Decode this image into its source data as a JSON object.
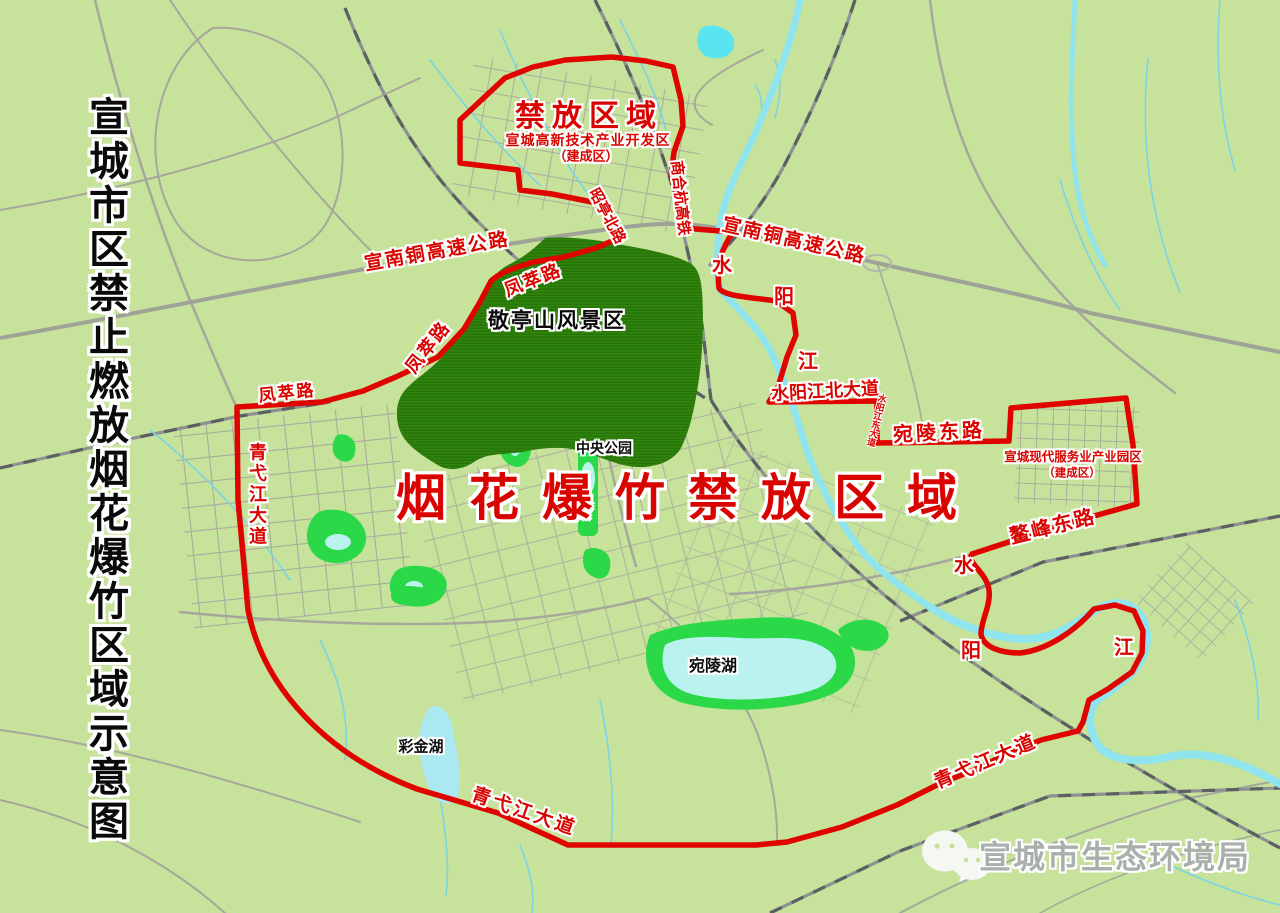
{
  "map_title": "宣城市区禁止燃放烟花爆竹区域示意图",
  "zones": {
    "north": {
      "title": "禁放区域",
      "subtitle": "宣城高新技术产业开发区",
      "note": "（建成区）"
    },
    "central": {
      "title": "烟花爆竹禁放区域"
    },
    "east": {
      "subtitle": "宣城现代服务业产业园区",
      "note": "（建成区）"
    }
  },
  "watermark": {
    "label": "宣城市生态环境局",
    "icon": "wechat-icon"
  },
  "colors": {
    "background_green": "#c7e29b",
    "boundary_red": "#df0400",
    "label_red": "#d90400",
    "mountain_green": "#2f850d",
    "park_green": "#2bd948",
    "lake_cyan": "#b9f2ee",
    "stream_cyan": "#7ad4e4",
    "road_gray": "#a5a89b",
    "rail_dark_gray": "#5c6062",
    "label_black": "#0c0c0c",
    "watermark_gray": "#a9b0ac"
  },
  "labels": [
    {
      "name": "zone-title-north",
      "text": "禁放区域"
    },
    {
      "name": "zone-subtitle-north",
      "text": "宣城高新技术产业开发区"
    },
    {
      "name": "zone-note-north",
      "text": "（建成区）"
    },
    {
      "name": "road-zhaoting-north",
      "text": "昭亭北路"
    },
    {
      "name": "rail-shanghehang",
      "text": "商合杭高铁"
    },
    {
      "name": "road-xuannantong-west",
      "text": "宣南铜高速公路"
    },
    {
      "name": "road-xuannantong-east",
      "text": "宣南铜高速公路"
    },
    {
      "name": "road-fengcui-upper",
      "text": "凤萃路"
    },
    {
      "name": "road-fengcui-diagonal",
      "text": "凤萃路"
    },
    {
      "name": "road-fengcui-west",
      "text": "凤萃路"
    },
    {
      "name": "place-jingtingshan",
      "text": "敬亭山风景区"
    },
    {
      "name": "river-shui-upper",
      "text": "水"
    },
    {
      "name": "river-yang-upper",
      "text": "阳"
    },
    {
      "name": "river-jiang-upper",
      "text": "江"
    },
    {
      "name": "road-shuiyangjiang-north-ave",
      "text": "水阳江北大道"
    },
    {
      "name": "road-shuiyangjiang-east-ave",
      "text": "水阳江东大道"
    },
    {
      "name": "road-wanling-east",
      "text": "宛陵东路"
    },
    {
      "name": "zone-subtitle-east",
      "text": "宣城现代服务业产业园区"
    },
    {
      "name": "zone-note-east",
      "text": "（建成区）"
    },
    {
      "name": "road-qiyijiang-ave-west",
      "text": "青弋江大道"
    },
    {
      "name": "place-central-park",
      "text": "中央公园"
    },
    {
      "name": "zone-title-central",
      "text": "烟花爆竹禁放区域"
    },
    {
      "name": "road-aofeng-east",
      "text": "鳌峰东路"
    },
    {
      "name": "place-wanling-lake",
      "text": "宛陵湖"
    },
    {
      "name": "place-caijin-lake",
      "text": "彩金湖"
    },
    {
      "name": "river-shui-lower",
      "text": "水"
    },
    {
      "name": "river-yang-lower",
      "text": "阳"
    },
    {
      "name": "river-jiang-lower",
      "text": "江"
    },
    {
      "name": "road-qiyijiang-ave-south",
      "text": "青弋江大道"
    },
    {
      "name": "road-qiyijiang-ave-southeast",
      "text": "青弋江大道"
    }
  ]
}
